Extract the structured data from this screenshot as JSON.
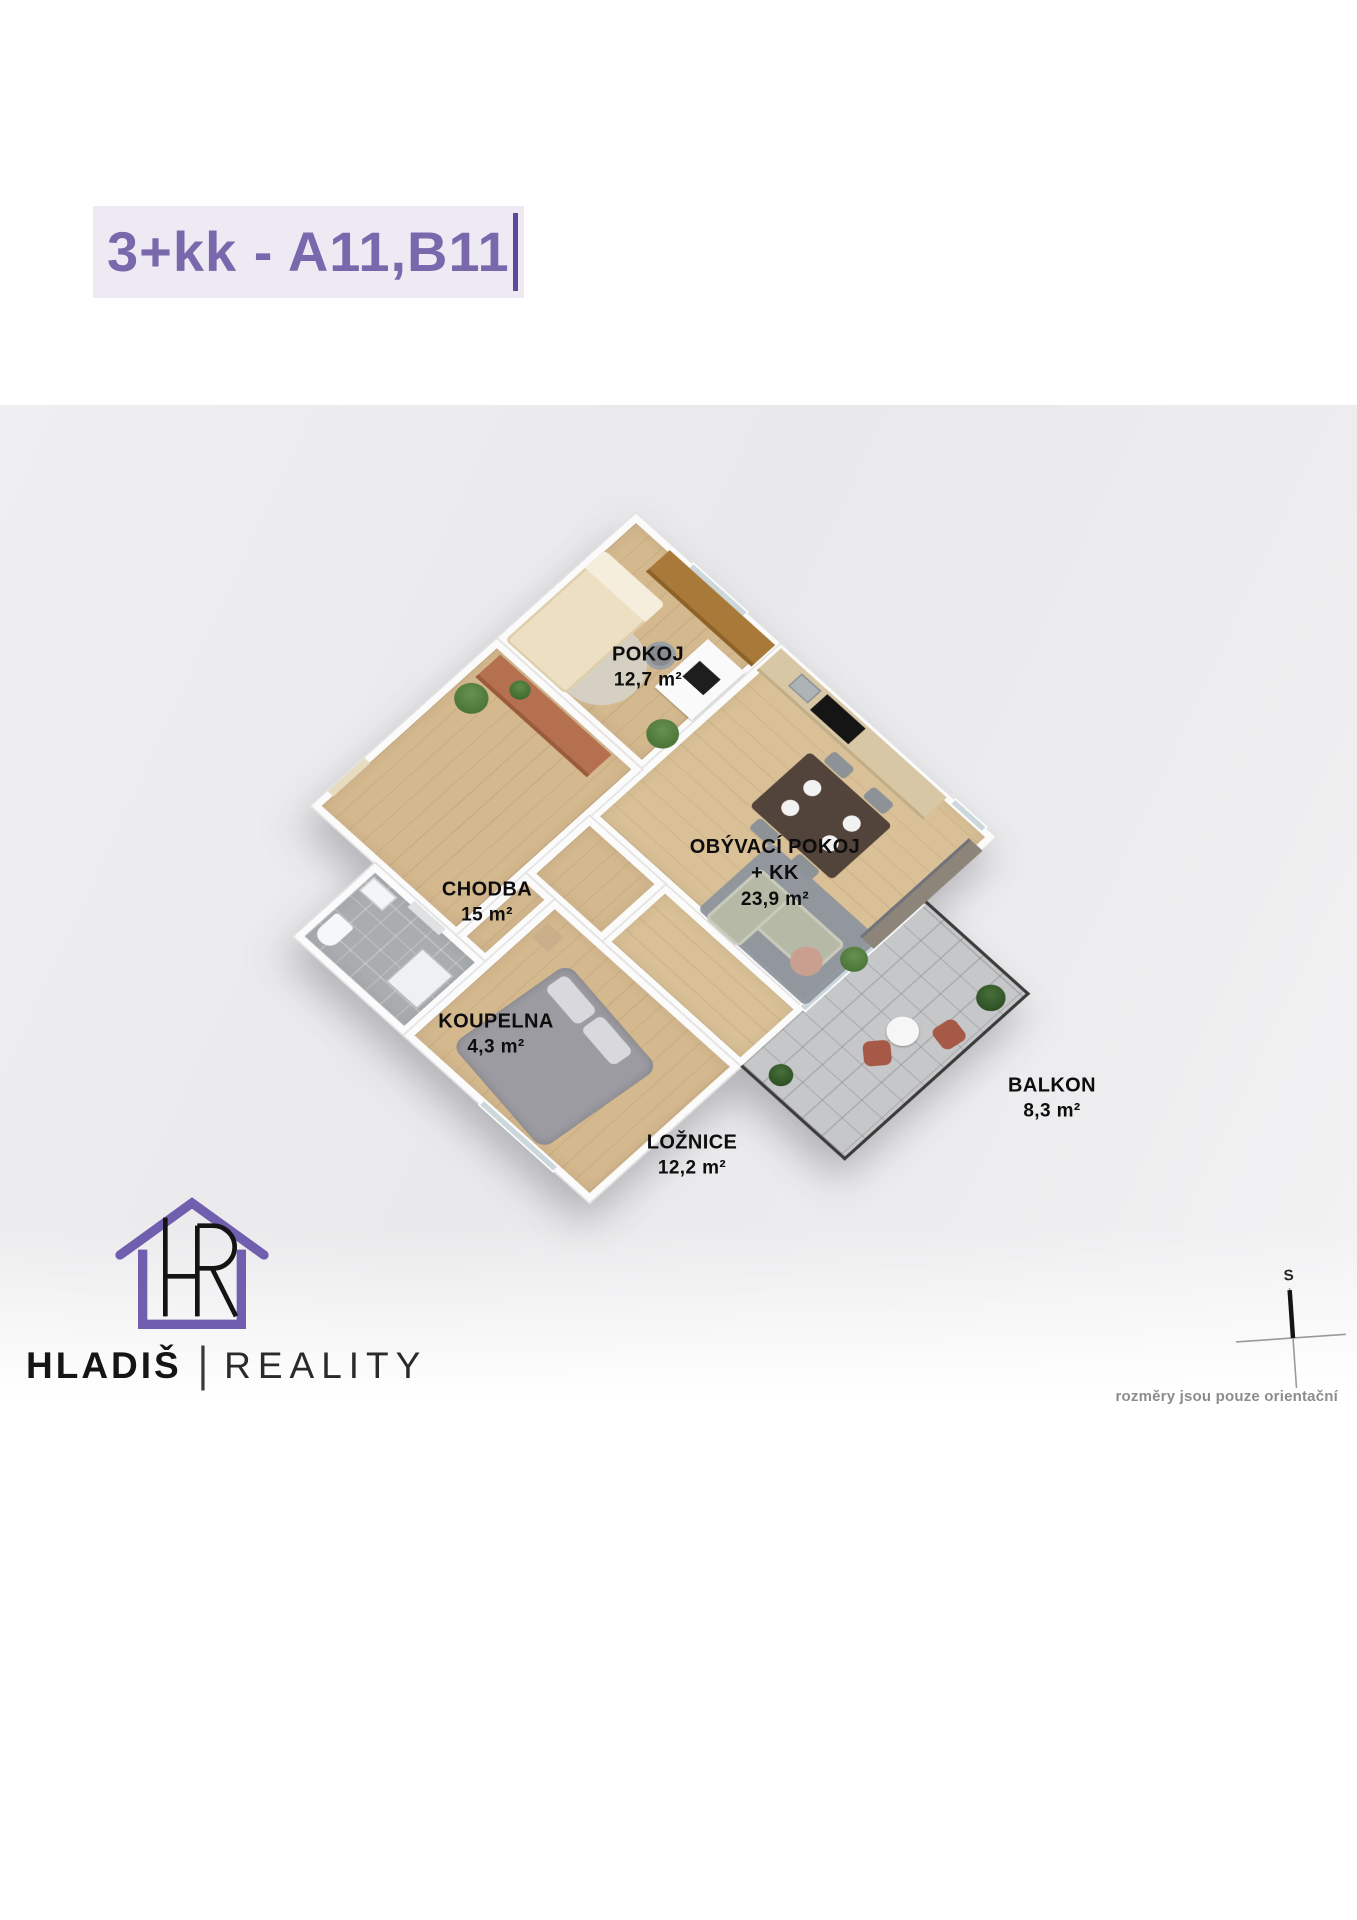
{
  "title": {
    "text": "3+kk - A11,B11"
  },
  "rooms": [
    {
      "name": "POKOJ",
      "area": "12,7 m²"
    },
    {
      "name": "CHODBA",
      "area": "15 m²"
    },
    {
      "name": "OBÝVACÍ POKOJ",
      "subname": "+ KK",
      "area": "23,9 m²"
    },
    {
      "name": "KOUPELNA",
      "area": "4,3 m²"
    },
    {
      "name": "LOŽNICE",
      "area": "12,2 m²"
    },
    {
      "name": "BALKON",
      "area": "8,3 m²"
    }
  ],
  "branding": {
    "company": "HLADIŠ",
    "divider": "|",
    "suffix": "REALITY"
  },
  "footnote": {
    "disclaimer": "rozměry jsou pouze orientační",
    "compass_north": "S"
  },
  "colors": {
    "accent_purple": "#7a68ac",
    "title_highlight": "#edeaf4",
    "cursor_purple": "#5b4a9b",
    "label_text": "#0d0d0d",
    "wood_floor": "#d4b88e",
    "bathroom_tile": "#a9adaf",
    "balcony_tile": "#c6c7c9",
    "wall_white": "#fbfbfb"
  }
}
